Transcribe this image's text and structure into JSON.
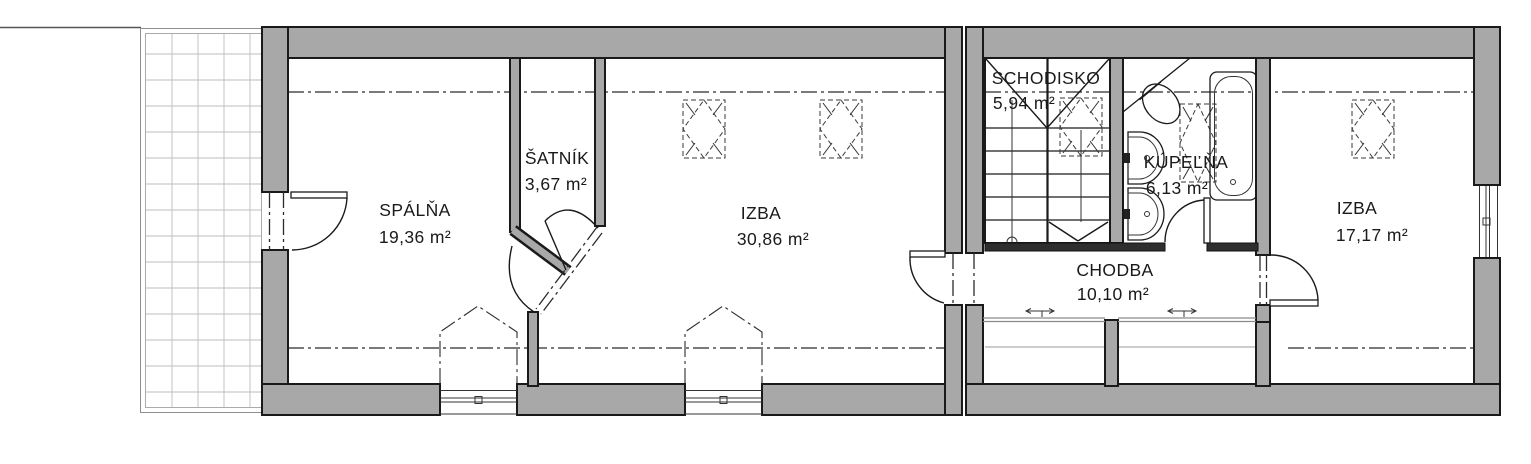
{
  "colors": {
    "wall_fill": "#a8a8a8",
    "wall_outline": "#1a1a1a",
    "interior_wall_dark": "#2e2e2e",
    "terrace_grid": "#bdbdbd",
    "glazing_line": "#8a8a8a",
    "background": "#ffffff"
  },
  "rooms": [
    {
      "name": "SPÁLŇA",
      "area": "19,36 m²"
    },
    {
      "name": "ŠATNÍK",
      "area": "3,67 m²"
    },
    {
      "name": "IZBA",
      "area": "30,86 m²"
    },
    {
      "name": "SCHODISKO",
      "area": "5,94 m²"
    },
    {
      "name": "KÚPEĽŇA",
      "area": "6,13 m²"
    },
    {
      "name": "CHODBA",
      "area": "10,10 m²"
    },
    {
      "name": "IZBA",
      "area": "17,17 m²"
    }
  ]
}
